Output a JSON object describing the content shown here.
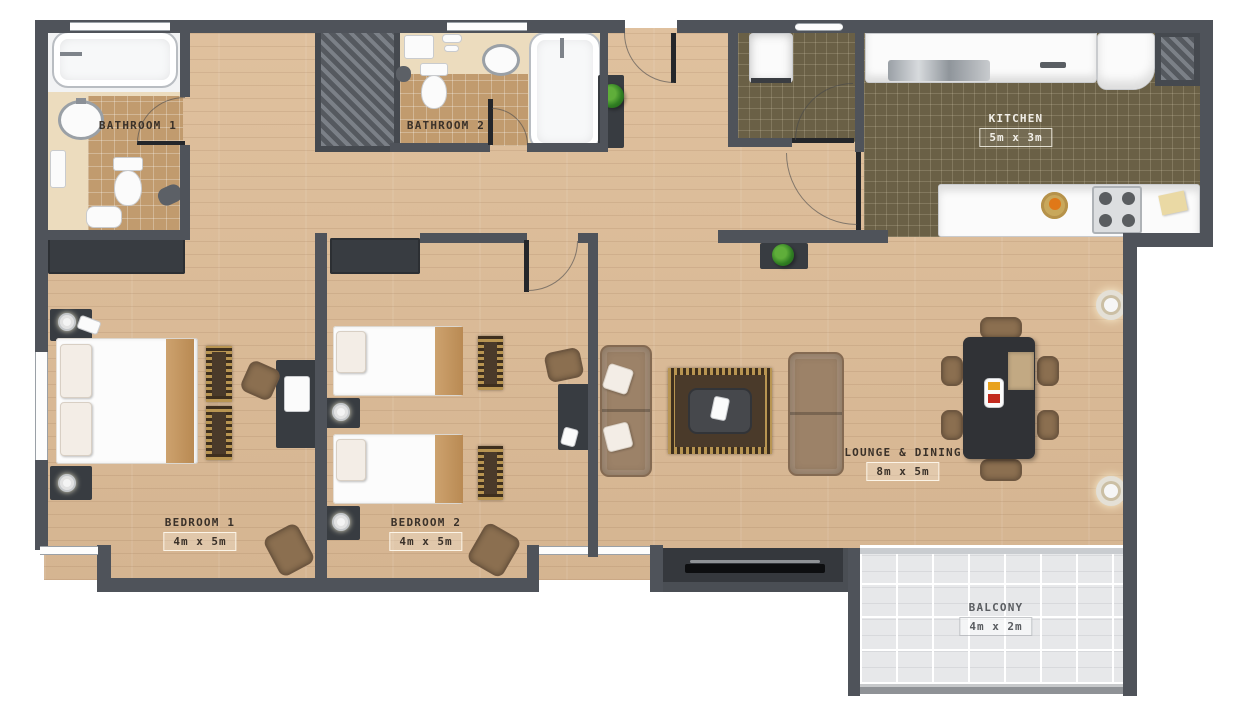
{
  "rooms": {
    "bathroom1": {
      "label": "BATHROOM 1"
    },
    "bathroom2": {
      "label": "BATHROOM 2"
    },
    "kitchen": {
      "label": "KITCHEN",
      "dims": "5m x 3m"
    },
    "bedroom1": {
      "label": "BEDROOM 1",
      "dims": "4m x 5m"
    },
    "bedroom2": {
      "label": "BEDROOM 2",
      "dims": "4m x 5m"
    },
    "lounge": {
      "label": "LOUNGE & DINING",
      "dims": "8m x 5m"
    },
    "balcony": {
      "label": "BALCONY",
      "dims": "4m x 2m"
    }
  },
  "colors": {
    "wall": "#4f535a",
    "wood_floor": "#d9ba97",
    "kitchen_floor": "#6a6046",
    "bathroom_tile": "#c19b6e",
    "bathroom_cream": "#ecdcbe",
    "balcony_tile": "#e7e8ea",
    "accent_tan": "#c29765",
    "furniture_dark": "#383c41",
    "sofa_brown": "#9c8268",
    "plant_green": "#3f8f2a"
  }
}
